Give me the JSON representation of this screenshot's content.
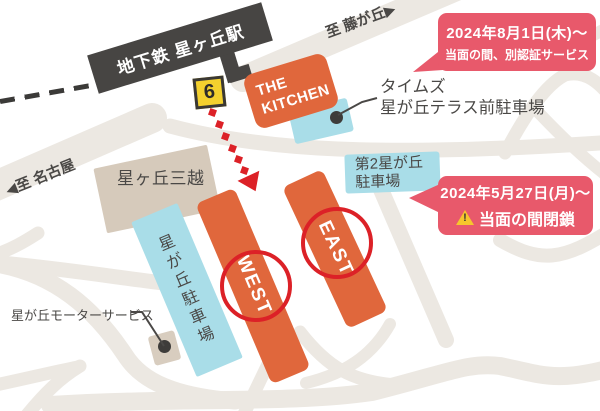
{
  "station": {
    "banner": "地下鉄 星ヶ丘駅",
    "exit_number": "6"
  },
  "directions": {
    "fujigaoka": "至 藤が丘▶",
    "nagoya": "◀至 名古屋"
  },
  "places": {
    "kitchen_line1": "THE",
    "kitchen_line2": "KITCHEN",
    "mitsukoshi": "星ヶ丘三越",
    "west": "WEST",
    "east": "EAST",
    "times_parking": "タイムズ\n星が丘テラス前駐車場",
    "dai2_parking": "第2星が丘\n駐車場",
    "hoshigaoka_parking_vertical": "星\nが\n丘\n駐\n車\n場",
    "motor_service": "星が丘モーターサービス"
  },
  "callouts": {
    "auth": {
      "line1": "2024年8月1日(木)～",
      "line2": "当面の間、別認証サービス"
    },
    "closed": {
      "line1": "2024年5月27日(月)～",
      "line2": "当面の間閉鎖",
      "warning_mark": "!"
    }
  },
  "colors": {
    "building_orange": "#E0673C",
    "callout_pink": "#E8596B",
    "parking_blue": "#A9DDE8",
    "building_beige": "#D6CABB",
    "exit_yellow": "#F4D12E",
    "accent_red": "#DC2127",
    "dark_gray": "#474543",
    "road_gray": "#ECE8E2",
    "text_gray": "#4A4846"
  }
}
